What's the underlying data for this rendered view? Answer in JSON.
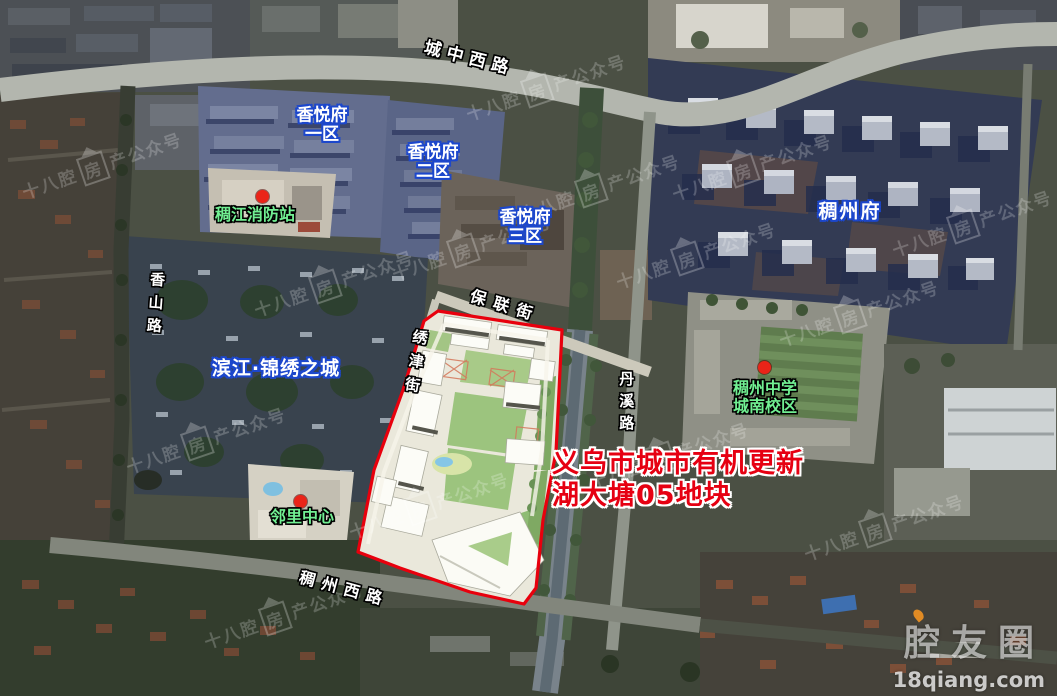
{
  "roads": {
    "chengzhong_west": "城中西路",
    "xiangshan": "香山路",
    "baolian": "保联街",
    "xiujin": "绣津街",
    "danxi": "丹溪路",
    "chouzhou_west": "稠州西路"
  },
  "estates": {
    "xiangyuefu1": {
      "line1": "香悦府",
      "line2": "一区"
    },
    "xiangyuefu2": {
      "line1": "香悦府",
      "line2": "二区"
    },
    "xiangyuefu3": {
      "line1": "香悦府",
      "line2": "三区"
    },
    "chouzhoufu": "稠州府",
    "binjiang": "滨江·锦绣之城"
  },
  "pois": {
    "fire_station": "稠江消防站",
    "neighborhood_center": "邻里中心",
    "school": {
      "line1": "稠州中学",
      "line2": "城南校区"
    }
  },
  "annotation": {
    "line1": "义乌市城市有机更新",
    "line2": "湖大塘05地块"
  },
  "watermark": {
    "prefix": "十八腔",
    "house": "房",
    "suffix": "产公众号"
  },
  "logo": {
    "name": "腔友圈",
    "site": "18qiang.com"
  },
  "colors": {
    "site_boundary": "#e8000d",
    "estate_label_stroke": "#1c47cc",
    "poi_label": "#71ef92",
    "annotation": "#e60012",
    "logo_accent": "#f29422"
  }
}
